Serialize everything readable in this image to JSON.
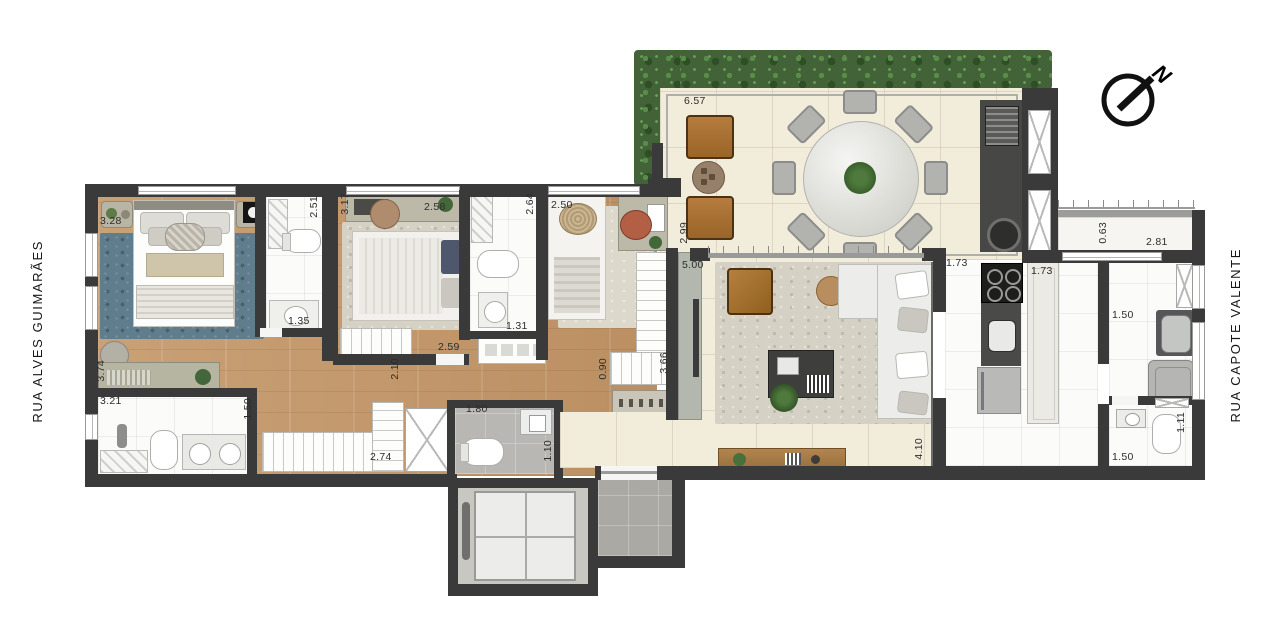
{
  "streets": {
    "left": "RUA ALVES GUIMARÃES",
    "right": "RUA CAPOTE VALENTE"
  },
  "compass": {
    "north_label": "N"
  },
  "dimensions": {
    "suite1_width": "3.28",
    "suite1_depth": "3.74",
    "suite1_bath_depth": "2.51",
    "suite1_bath_width": "1.35",
    "bedroom2_depth": "3.17",
    "bedroom2_width": "2.58",
    "bedroom2_lower_width": "2.59",
    "bath2_depth": "2.64",
    "bath2_width": "1.31",
    "bedroom3_width": "2.50",
    "bedroom3_lower_width": "0.90",
    "bedroom3_wardrobe": "3.66",
    "terrace_width": "6.57",
    "terrace_depth": "2.99",
    "living_width": "5.00",
    "living_depth": "4.10",
    "living_wall": "1.73",
    "kitchen_counter": "1.73",
    "service_ledge_depth": "0.63",
    "service_ledge_width": "2.81",
    "laundry_width_top": "1.50",
    "laundry_width_bottom": "1.50",
    "wc_depth": "1.11",
    "hall_width": "2.10",
    "master_bath_width": "3.21",
    "master_bath_depth": "1.50",
    "closet_width": "2.74",
    "lavabo_width": "1.80",
    "lavabo_depth": "1.10"
  },
  "palette": {
    "wall": "#3a3a3a",
    "wood_floor": "#c59c6f",
    "cream_tile": "#f2ecdb",
    "white_tile": "#fbfbfa",
    "gray_tile": "#b8b7b3",
    "hedge_green": "#426337",
    "blue_rug": "#5f7d8d",
    "lounge_brown": "#ad7635",
    "marble_table": "#e8e8e4"
  }
}
